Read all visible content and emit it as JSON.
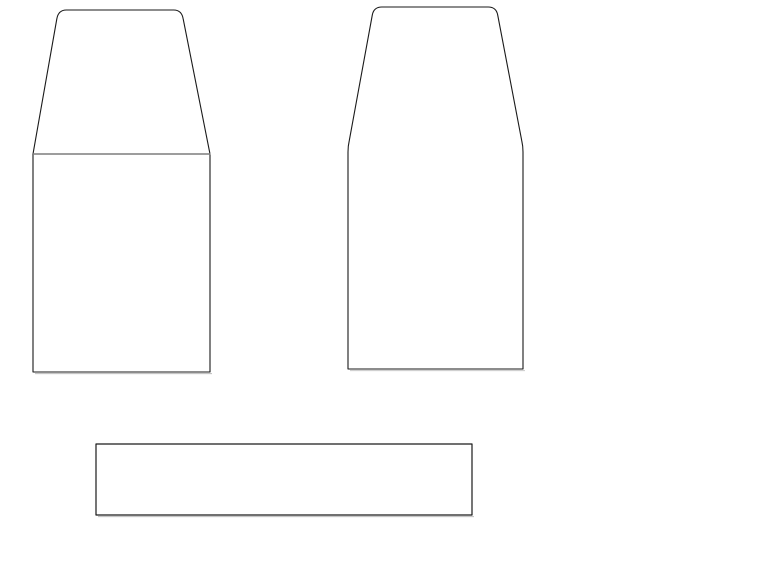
{
  "canvas": {
    "width": 768,
    "height": 576,
    "background": "#ffffff"
  },
  "colors": {
    "outline": "#1a1a1a",
    "divider": "#7d7d7d",
    "shadow": "#bdbdbd",
    "fill": "#ffffff"
  },
  "shapes": [
    {
      "name": "left-container-top-trapezoid",
      "kind": "outline",
      "interactable": true,
      "d": "M 33 154 L 56.8 19 Q 58.3 10 66.3 10 L 173.7 10 Q 181.7 10 183.2 19 L 210 154",
      "stroke": "#1a1a1a",
      "stroke_width": 1.1,
      "fill": "#ffffff"
    },
    {
      "name": "left-container-body-rect",
      "kind": "outline",
      "interactable": true,
      "d": "M 33 154 L 33 372 L 210 372 L 210 154",
      "stroke": "#1a1a1a",
      "stroke_width": 1.1,
      "fill": "#ffffff"
    },
    {
      "name": "left-container-divider-line",
      "kind": "divider",
      "interactable": true,
      "d": "M 33 154 L 210.5 154",
      "stroke": "#7d7d7d",
      "stroke_width": 1.6,
      "fill": "none"
    },
    {
      "name": "left-container-bottom-shadow",
      "kind": "shadow",
      "interactable": false,
      "d": "M 35 373.6 L 212 373.6",
      "stroke": "#bdbdbd",
      "stroke_width": 1,
      "fill": "none"
    },
    {
      "name": "right-container-outline",
      "kind": "outline",
      "interactable": true,
      "d": "M 348 369 L 348 152 Q 348 146 349.2 141 L 372.3 15 Q 373.8 7 381.8 7 L 488.2 7 Q 496.2 7 497.7 15 L 521.8 141 Q 523 146 523 152 L 523 369 Z",
      "stroke": "#1a1a1a",
      "stroke_width": 1.1,
      "fill": "#ffffff"
    },
    {
      "name": "right-container-bottom-shadow",
      "kind": "shadow",
      "interactable": false,
      "d": "M 350 370.6 L 525 370.6",
      "stroke": "#c9c9c9",
      "stroke_width": 1,
      "fill": "none"
    },
    {
      "name": "bottom-bar-rect",
      "kind": "outline",
      "interactable": true,
      "d": "M 96 444 L 472 444 L 472 515 L 96 515 Z",
      "stroke": "#1a1a1a",
      "stroke_width": 1.2,
      "fill": "#ffffff"
    },
    {
      "name": "bottom-bar-bottom-shadow",
      "kind": "shadow",
      "interactable": false,
      "d": "M 98 516.6 L 474 516.6",
      "stroke": "#bdbdbd",
      "stroke_width": 1,
      "fill": "none"
    }
  ]
}
